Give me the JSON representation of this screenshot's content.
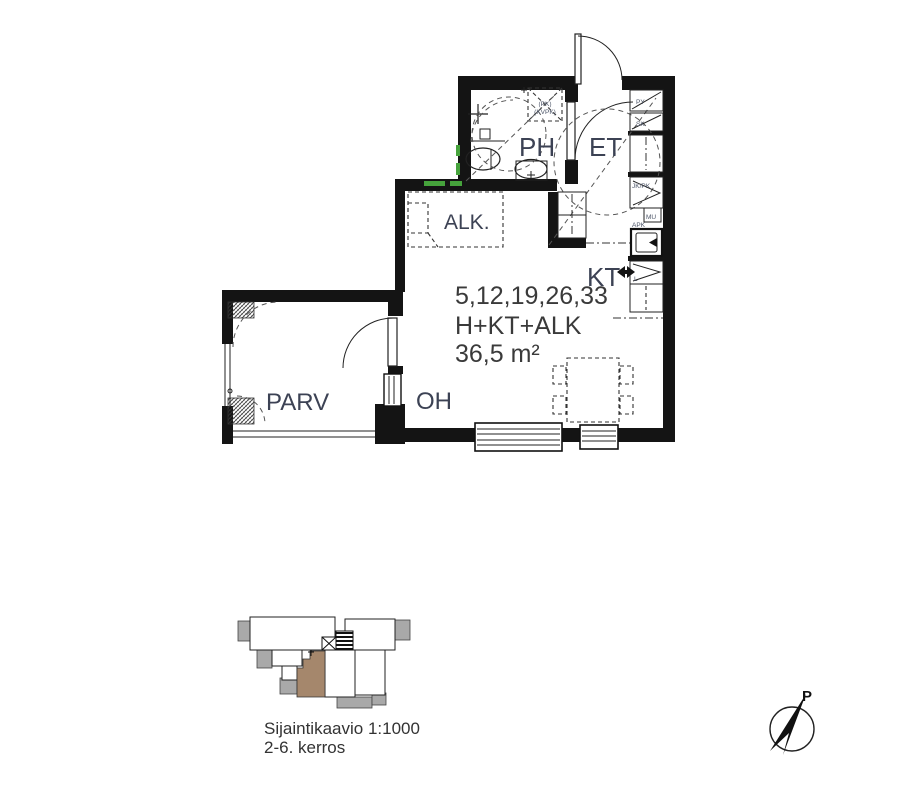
{
  "plan": {
    "rooms": {
      "ph": "PH",
      "et": "ET",
      "alk": "ALK.",
      "kt": "KT",
      "oh": "OH",
      "parv": "PARV"
    },
    "info": {
      "line1": "5,12,19,26,33",
      "line2": "H+KT+ALK",
      "line3": "36,5 m²"
    },
    "kitchen": {
      "py": "PY",
      "sk": "SK",
      "jk_pk": "JK/PK",
      "mu": "MU",
      "apk": "APK",
      "l": "L"
    },
    "laundry_reservation": {
      "line1": "(PK)",
      "line2": "(KVPK)"
    },
    "colors": {
      "wall": "#141414",
      "label": "#3c4254",
      "small_label": "#4c5568",
      "accent_green": "#46a33c"
    }
  },
  "location_diagram": {
    "caption_line1": "Sijaintikaavio 1:1000",
    "caption_line2": "2-6. kerros",
    "colors": {
      "highlight": "#a5876c",
      "balcony": "#a9a9a9"
    }
  },
  "compass": {
    "north_label": "P"
  }
}
